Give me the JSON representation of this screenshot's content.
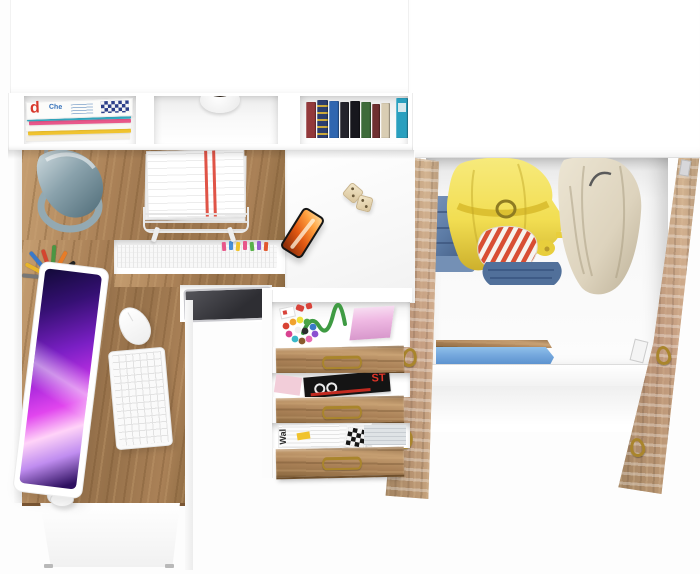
{
  "palette": {
    "bg": "#fdfdfd",
    "panel": "#ffffff",
    "wood-a": "#aa8157",
    "wood-light": "#c59e71",
    "wood-dark": "#7d5c34",
    "lamp-a": "#cfdbdf",
    "lamp-b": "#4e6b77",
    "lamp-ring": "#93a9b2",
    "screen-a": "#120a38",
    "screen-b": "#7a1fc4",
    "screen-c": "#e145ee",
    "screen-d": "#ffd3f8",
    "denim-a": "#5d7ca6",
    "denim-b": "#40597f",
    "jacket-a": "#f2de52",
    "jacket-b": "#d9bd2e",
    "coat-a": "#e2dac6",
    "coat-b": "#c0b59c",
    "stripe-red": "#d84e33",
    "shelf-blue": "#74a7dd",
    "handle-gold": "#a9852c",
    "phone-a": "#ffa13f",
    "phone-b": "#92300a",
    "paper-red": "#e05447",
    "cord-green": "#3f9b43",
    "pink-pad": "#efb9e3",
    "plant-dark": "#2b2117",
    "device-a": "#55555b",
    "device-b": "#c9c9ce"
  },
  "hutch": {
    "magazines": {
      "cover_letter": "d",
      "cover_word": "Che",
      "strip_colors": [
        "#f3efe6",
        "#f0c32e",
        "#f8f8f5",
        "#e8578a",
        "#34b0c8"
      ]
    },
    "books": {
      "colors": [
        "#93393b",
        "#2c3e6f",
        "#2f66b0",
        "#24242c",
        "#17171d",
        "#3e6b3a",
        "#6f2f30",
        "#d9cdb3",
        "#2aa0bf"
      ]
    }
  },
  "desk": {
    "pencil_colors": [
      "#777777",
      "#e8b52a",
      "#3a79c9",
      "#d4452f",
      "#4a9643",
      "#e87c27",
      "#222222",
      "#58c0d8"
    ],
    "paper_tab_colors": [
      "#e8578a",
      "#4a90d9",
      "#f0c32e",
      "#e8578a",
      "#58b24a",
      "#9a5fd0",
      "#e2572e"
    ]
  },
  "drawers": {
    "magazine_title": "ST",
    "newspaper_title": "Wal",
    "bead_colors": [
      "#d84333",
      "#f0a22e",
      "#efe13a",
      "#4ba447",
      "#3a79c9",
      "#8a4fd0",
      "#e86ab2",
      "#8a5a2e",
      "#39b8c9",
      "#d84390",
      "#f0f0f0",
      "#2c2c2c"
    ]
  }
}
